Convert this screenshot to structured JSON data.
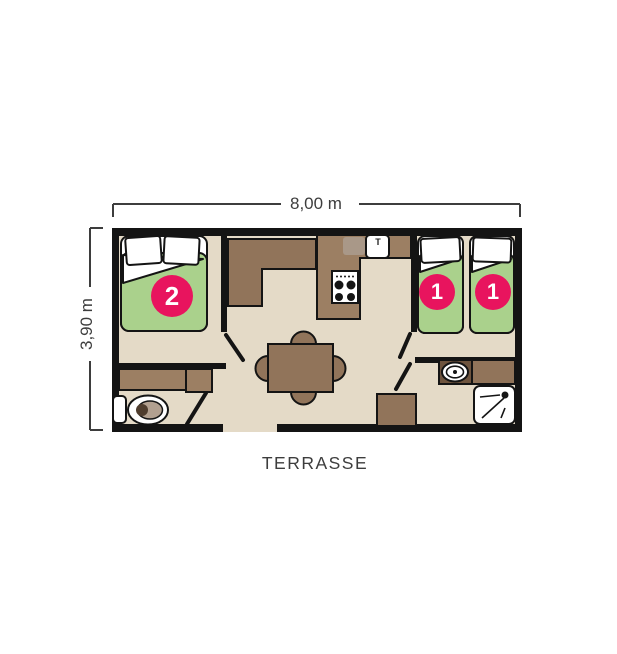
{
  "labels": {
    "width_dimension": "8,00 m",
    "depth_dimension": "3,90 m",
    "terrace": "TERRASSE"
  },
  "beds": {
    "double_bed_badge": "2",
    "single_bed_1_badge": "1",
    "single_bed_2_badge": "1"
  },
  "kitchen": {
    "sink_faucet": "T"
  },
  "colors": {
    "floor": "#e4dac7",
    "wall": "#141414",
    "furniture_brown": "#91745a",
    "kitchen_brown": "#9c7f63",
    "dark_brown": "#6e543e",
    "drainboard_gray": "#a99888",
    "mattress_green": "#aad18c",
    "badge_pink": "#e8145e",
    "text_gray": "#3d3d3d"
  }
}
